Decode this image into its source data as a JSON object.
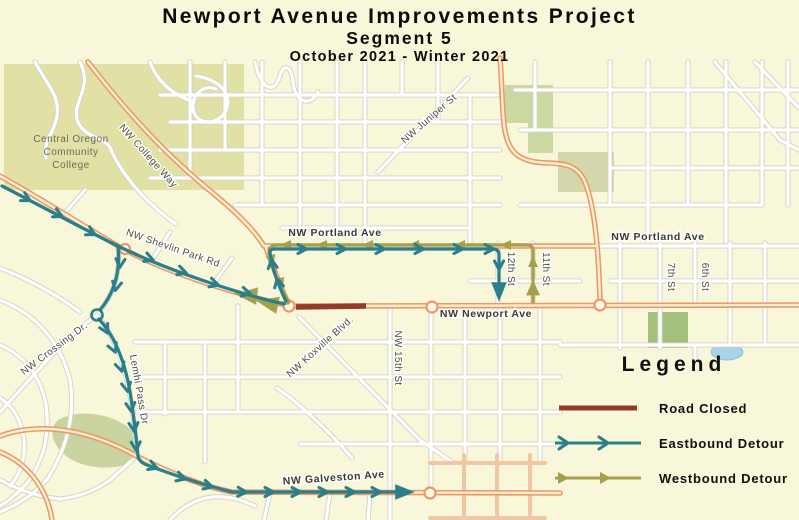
{
  "title": {
    "line1": "Newport Avenue Improvements Project",
    "line2": "Segment 5",
    "line3": "October 2021 - Winter 2021"
  },
  "legend": {
    "heading": "Legend",
    "items": [
      {
        "label": "Road Closed",
        "type": "road-closed",
        "color": "#943A28"
      },
      {
        "label": "Eastbound Detour",
        "type": "eastbound-detour",
        "color": "#2A7F8A"
      },
      {
        "label": "Westbound Detour",
        "type": "westbound-detour",
        "color": "#A6A04E"
      }
    ]
  },
  "map": {
    "colors": {
      "background": "#f8f7d9",
      "closed_red": "#943A28",
      "eastbound_teal": "#2A7F8A",
      "westbound_olive": "#A6A04E",
      "arterial_orange": "#E9996A",
      "park_green": "#ccd8a2",
      "water_blue": "#a9d3e6"
    },
    "street_labels": [
      {
        "text": "NW College Way",
        "x": 146,
        "y": 158,
        "rot": 48
      },
      {
        "text": "NW Juniper St",
        "x": 431,
        "y": 121,
        "rot": -41
      },
      {
        "text": "NW Shevlin Park Rd",
        "x": 172,
        "y": 251,
        "rot": 19
      },
      {
        "text": "NW Portland Ave",
        "x": 335,
        "y": 236,
        "rot": 0,
        "cls": "major"
      },
      {
        "text": "NW Portland Ave",
        "x": 658,
        "y": 240,
        "rot": 0,
        "cls": "major"
      },
      {
        "text": "NW Newport Ave",
        "x": 486,
        "y": 317,
        "rot": 0,
        "cls": "major"
      },
      {
        "text": "12th St",
        "x": 508,
        "y": 269,
        "rot": 90
      },
      {
        "text": "11th St",
        "x": 543,
        "y": 269,
        "rot": 90
      },
      {
        "text": "7th St",
        "x": 668,
        "y": 277,
        "rot": 90
      },
      {
        "text": "6th St",
        "x": 702,
        "y": 277,
        "rot": 90
      },
      {
        "text": "NW 15th St",
        "x": 395,
        "y": 358,
        "rot": 90
      },
      {
        "text": "NW Koxville Blvd.",
        "x": 322,
        "y": 349,
        "rot": -42
      },
      {
        "text": "NW Crossing Dr.",
        "x": 56,
        "y": 351,
        "rot": -37
      },
      {
        "text": "Lemhi Pass Dr",
        "x": 136,
        "y": 390,
        "rot": 80
      },
      {
        "text": "NW Galveston Ave",
        "x": 334,
        "y": 481,
        "rot": -4,
        "cls": "major"
      }
    ],
    "area_labels": [
      {
        "text": "Central Oregon",
        "x": 71,
        "y": 142
      },
      {
        "text": "Community",
        "x": 71,
        "y": 155
      },
      {
        "text": "College",
        "x": 71,
        "y": 168
      }
    ]
  }
}
